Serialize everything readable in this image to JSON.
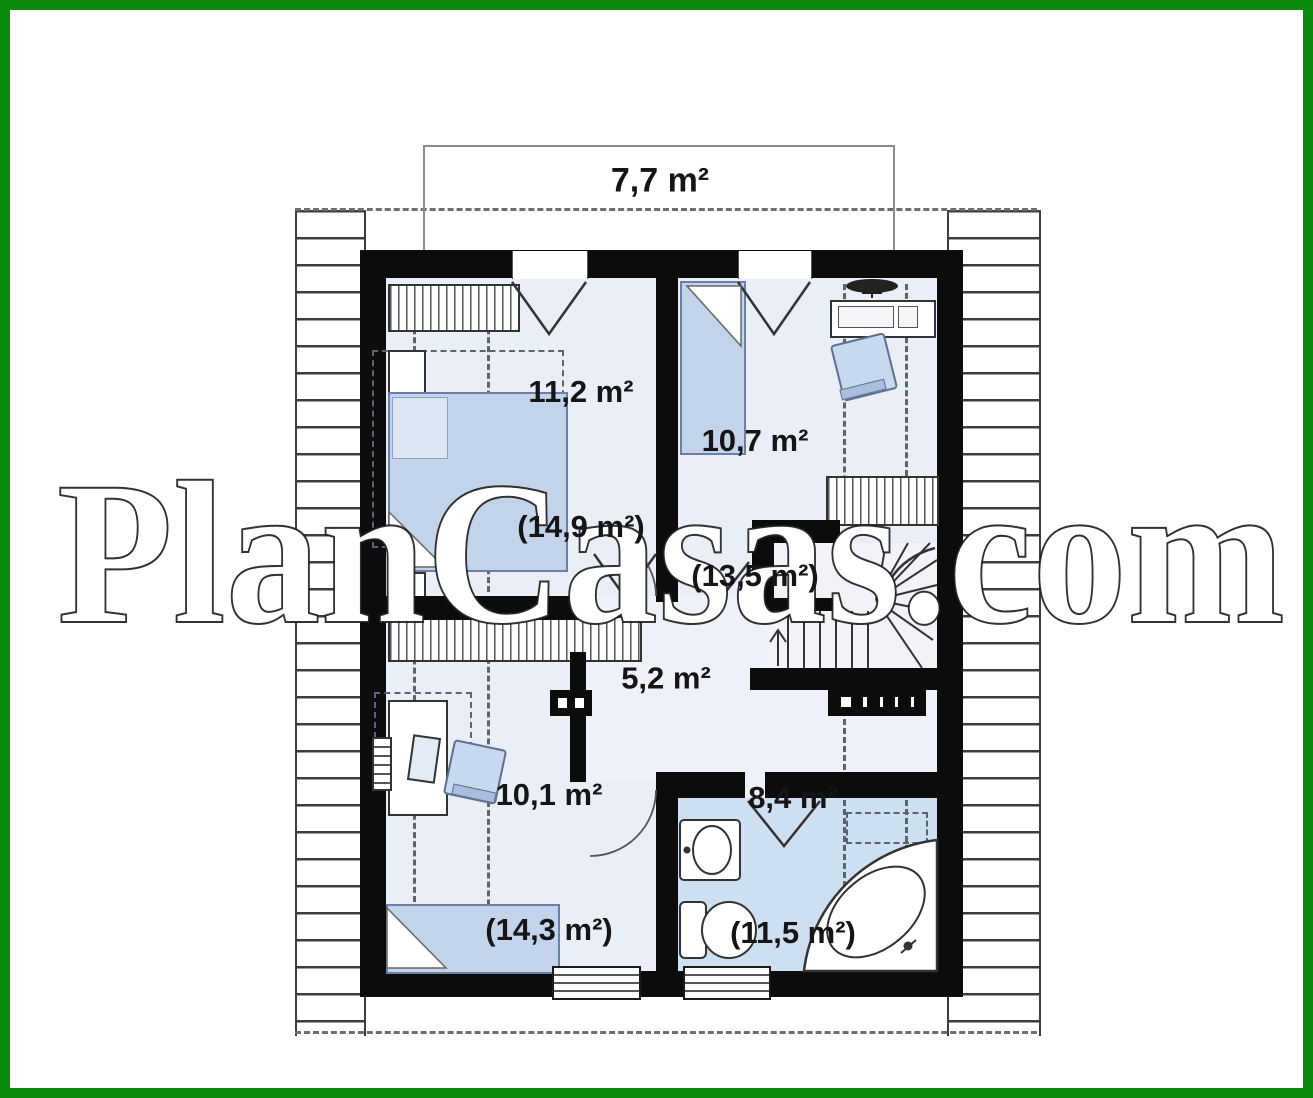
{
  "watermark": {
    "text": "PlanCasas.com"
  },
  "colors": {
    "frame_green": "#0a8a0a",
    "wall_black": "#0c0c0c",
    "room_fill": "#e9eef7",
    "bathroom_fill": "#cfdff2",
    "furniture_blue": "#c3d4ea",
    "dash_gray": "#5b6472"
  },
  "plan": {
    "attic": {
      "label": "7,7 m²"
    },
    "rooms": [
      {
        "name": "bedroom-top-left",
        "area": "11,2 m²",
        "area_total": "(14,9 m²)"
      },
      {
        "name": "bedroom-top-right",
        "area": "10,7 m²",
        "area_total": "(13,5 m²)"
      },
      {
        "name": "hallway",
        "area": "5,2 m²",
        "area_total": ""
      },
      {
        "name": "bedroom-bottom-left",
        "area": "10,1 m²",
        "area_total": "(14,3 m²)"
      },
      {
        "name": "bathroom",
        "area": "8,4 m²",
        "area_total": "(11,5 m²)"
      }
    ]
  }
}
